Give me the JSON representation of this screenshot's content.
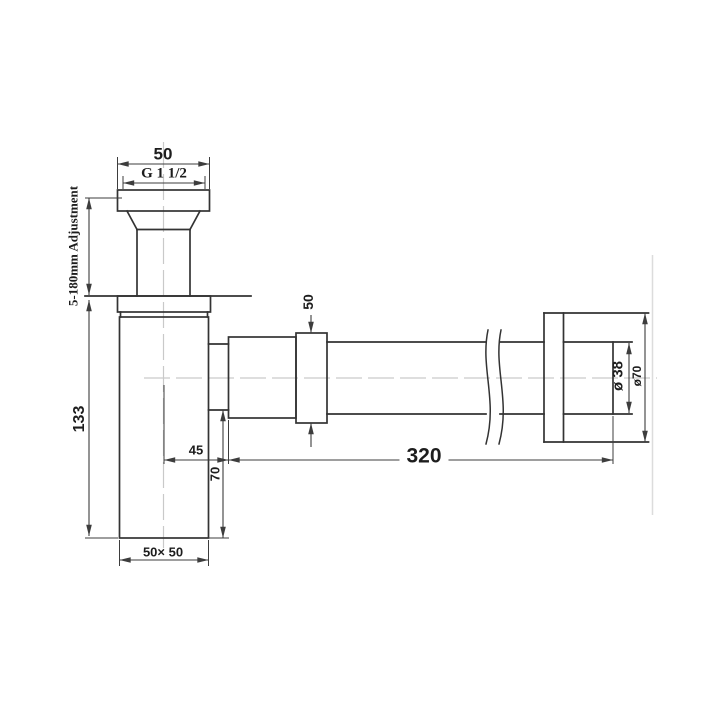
{
  "drawing": {
    "type": "technical-dimension-drawing",
    "subject": "bottle trap with wall outlet pipe",
    "line_color": "#333333",
    "dimension_line_color": "#3d3d3d",
    "centerline_color": "#c9c9c9",
    "background": "#ffffff",
    "labels": {
      "top_width": "50",
      "thread_size": "G 1 1/2",
      "adjustment_range": "5-180mm Adjustment",
      "body_height": "133",
      "body_footprint": "50× 50",
      "trap_offset": "45",
      "outlet_drop": "70",
      "nut_height": "50",
      "pipe_length": "320",
      "pipe_diameter": "ø 38",
      "flange_diameter": "ø70"
    }
  }
}
